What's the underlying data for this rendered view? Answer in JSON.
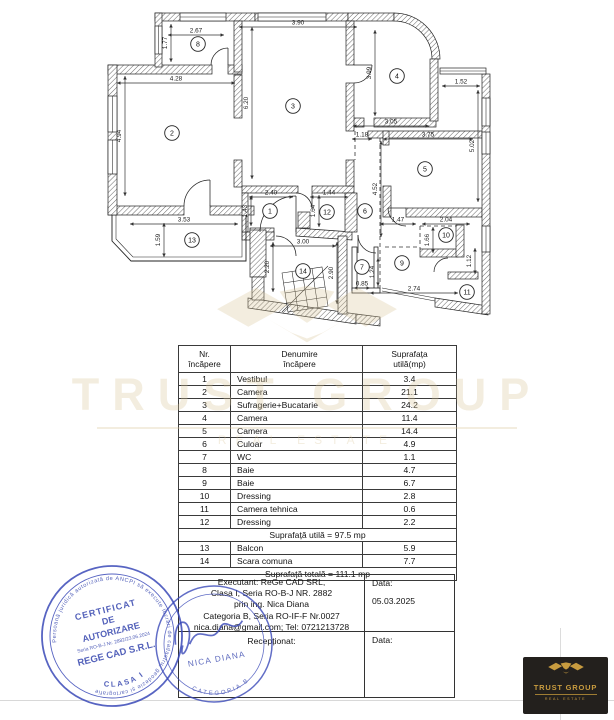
{
  "plan": {
    "dimensions": [
      {
        "v": "2.67",
        "o": "h",
        "x": 196,
        "y": 31,
        "l": 56
      },
      {
        "v": "1.77",
        "o": "v",
        "x": 166,
        "y": 43,
        "l": 38
      },
      {
        "v": "3.90",
        "o": "h",
        "x": 298,
        "y": 23,
        "l": 118
      },
      {
        "v": "4.28",
        "o": "h",
        "x": 176,
        "y": 79,
        "l": 118
      },
      {
        "v": "4.94",
        "o": "v",
        "x": 120,
        "y": 136,
        "l": 120
      },
      {
        "v": "6.20",
        "o": "v",
        "x": 247,
        "y": 103,
        "l": 152
      },
      {
        "v": "3.99",
        "o": "v",
        "x": 370,
        "y": 73,
        "l": 86
      },
      {
        "v": "3.05",
        "o": "h",
        "x": 391,
        "y": 122,
        "l": 76
      },
      {
        "v": "1.52",
        "o": "h",
        "x": 461,
        "y": 82,
        "l": 38
      },
      {
        "v": "1.18",
        "o": "h",
        "x": 362,
        "y": 135,
        "l": 20
      },
      {
        "v": "3.75",
        "o": "h",
        "x": 428,
        "y": 135,
        "l": 90
      },
      {
        "v": "5.02",
        "o": "v",
        "x": 473,
        "y": 146,
        "l": 112
      },
      {
        "v": "2.40",
        "o": "h",
        "x": 271,
        "y": 193,
        "l": 44
      },
      {
        "v": "1.43",
        "o": "v",
        "x": 246,
        "y": 211,
        "l": 30
      },
      {
        "v": "1.44",
        "o": "h",
        "x": 329,
        "y": 193,
        "l": 38
      },
      {
        "v": "1.64",
        "o": "v",
        "x": 314,
        "y": 211,
        "l": 32
      },
      {
        "v": "4.52",
        "o": "v",
        "x": 376,
        "y": 189,
        "l": 96
      },
      {
        "v": "1.47",
        "o": "h",
        "x": 398,
        "y": 220,
        "l": 36
      },
      {
        "v": "2.04",
        "o": "h",
        "x": 446,
        "y": 220,
        "l": 48
      },
      {
        "v": "1.66",
        "o": "v",
        "x": 428,
        "y": 240,
        "l": 26
      },
      {
        "v": "1.12",
        "o": "v",
        "x": 470,
        "y": 261,
        "l": 26
      },
      {
        "v": "3.53",
        "o": "h",
        "x": 184,
        "y": 220,
        "l": 108
      },
      {
        "v": "1.59",
        "o": "v",
        "x": 159,
        "y": 240,
        "l": 34
      },
      {
        "v": "3.00",
        "o": "h",
        "x": 303,
        "y": 242,
        "l": 66
      },
      {
        "v": "2.20",
        "o": "v",
        "x": 268,
        "y": 267,
        "l": 50
      },
      {
        "v": "2.90",
        "o": "v",
        "x": 332,
        "y": 273,
        "l": 62
      },
      {
        "v": "0.85",
        "o": "h",
        "x": 362,
        "y": 284,
        "l": 16
      },
      {
        "v": "1.24",
        "o": "v",
        "x": 373,
        "y": 272,
        "l": 28
      },
      {
        "v": "2.74",
        "o": "h",
        "x": 414,
        "y": 289,
        "l": 88
      }
    ],
    "rooms": [
      {
        "n": "1",
        "x": 270,
        "y": 211
      },
      {
        "n": "2",
        "x": 172,
        "y": 133
      },
      {
        "n": "3",
        "x": 293,
        "y": 106
      },
      {
        "n": "4",
        "x": 397,
        "y": 76
      },
      {
        "n": "5",
        "x": 425,
        "y": 169
      },
      {
        "n": "6",
        "x": 365,
        "y": 211
      },
      {
        "n": "7",
        "x": 362,
        "y": 267
      },
      {
        "n": "8",
        "x": 198,
        "y": 44
      },
      {
        "n": "9",
        "x": 402,
        "y": 263
      },
      {
        "n": "10",
        "x": 446,
        "y": 235
      },
      {
        "n": "11",
        "x": 467,
        "y": 292
      },
      {
        "n": "12",
        "x": 327,
        "y": 212
      },
      {
        "n": "13",
        "x": 192,
        "y": 240
      },
      {
        "n": "14",
        "x": 303,
        "y": 271
      }
    ]
  },
  "table": {
    "header": {
      "c1a": "Nr.",
      "c1b": "încăpere",
      "c2a": "Denumire",
      "c2b": "încăpere",
      "c3a": "Suprafața",
      "c3b": "utilă(mp)"
    },
    "rows": [
      {
        "nr": "1",
        "name": "Vestibul",
        "area": "3.4"
      },
      {
        "nr": "2",
        "name": "Camera",
        "area": "21.1"
      },
      {
        "nr": "3",
        "name": "Sufragerie+Bucatarie",
        "area": "24.2"
      },
      {
        "nr": "4",
        "name": "Camera",
        "area": "11.4"
      },
      {
        "nr": "5",
        "name": "Camera",
        "area": "14.4"
      },
      {
        "nr": "6",
        "name": "Culoar",
        "area": "4.9"
      },
      {
        "nr": "7",
        "name": "WC",
        "area": "1.1"
      },
      {
        "nr": "8",
        "name": "Baie",
        "area": "4.7"
      },
      {
        "nr": "9",
        "name": "Baie",
        "area": "6.7"
      },
      {
        "nr": "10",
        "name": "Dressing",
        "area": "2.8"
      },
      {
        "nr": "11",
        "name": "Camera tehnica",
        "area": "0.6"
      },
      {
        "nr": "12",
        "name": "Dressing",
        "area": "2.2"
      }
    ],
    "subtotal": "Suprafață utilă = 97.5 mp",
    "rows2": [
      {
        "nr": "13",
        "name": "Balcon",
        "area": "5.9"
      },
      {
        "nr": "14",
        "name": "Scara comuna",
        "area": "7.7"
      }
    ],
    "total": "Suprafață totală = 111.1 mp"
  },
  "exec": {
    "lines": [
      "Executant: ReGe CAD SRL,",
      "Clasa I, Seria RO-B-J NR. 2882",
      "prin ing. Nica Diana",
      "Categoria B, Seria RO-IF-F Nr.0027",
      "nica.diana@gmail.com; Tel: 0721213728"
    ],
    "data_label": "Data:",
    "date": "05.03.2025",
    "receptionat": "Recepționat:",
    "data_label2": "Data:"
  },
  "stamps": {
    "round1": {
      "ring": "Persoană juridică autorizată de ANCPI să execute lucrări de cadastru, geodezie și cartografie",
      "l1": "CERTIFICAT",
      "l2": "DE",
      "l3": "AUTORIZARE",
      "l4": "Seria RO-B-J Nr. 2882/23.06.2024",
      "l5": "REGE CAD S.R.L.",
      "l6": "CLASA I",
      "color": "#3a49b8"
    },
    "round2": {
      "name": "NICA DIANA",
      "arc": "CATEGORIA B",
      "color": "#3a49b8"
    }
  },
  "logo": {
    "title": "TRUST GROUP",
    "subtitle": "REAL ESTATE",
    "gold": "#c79b3f",
    "bg": "#23201d"
  }
}
